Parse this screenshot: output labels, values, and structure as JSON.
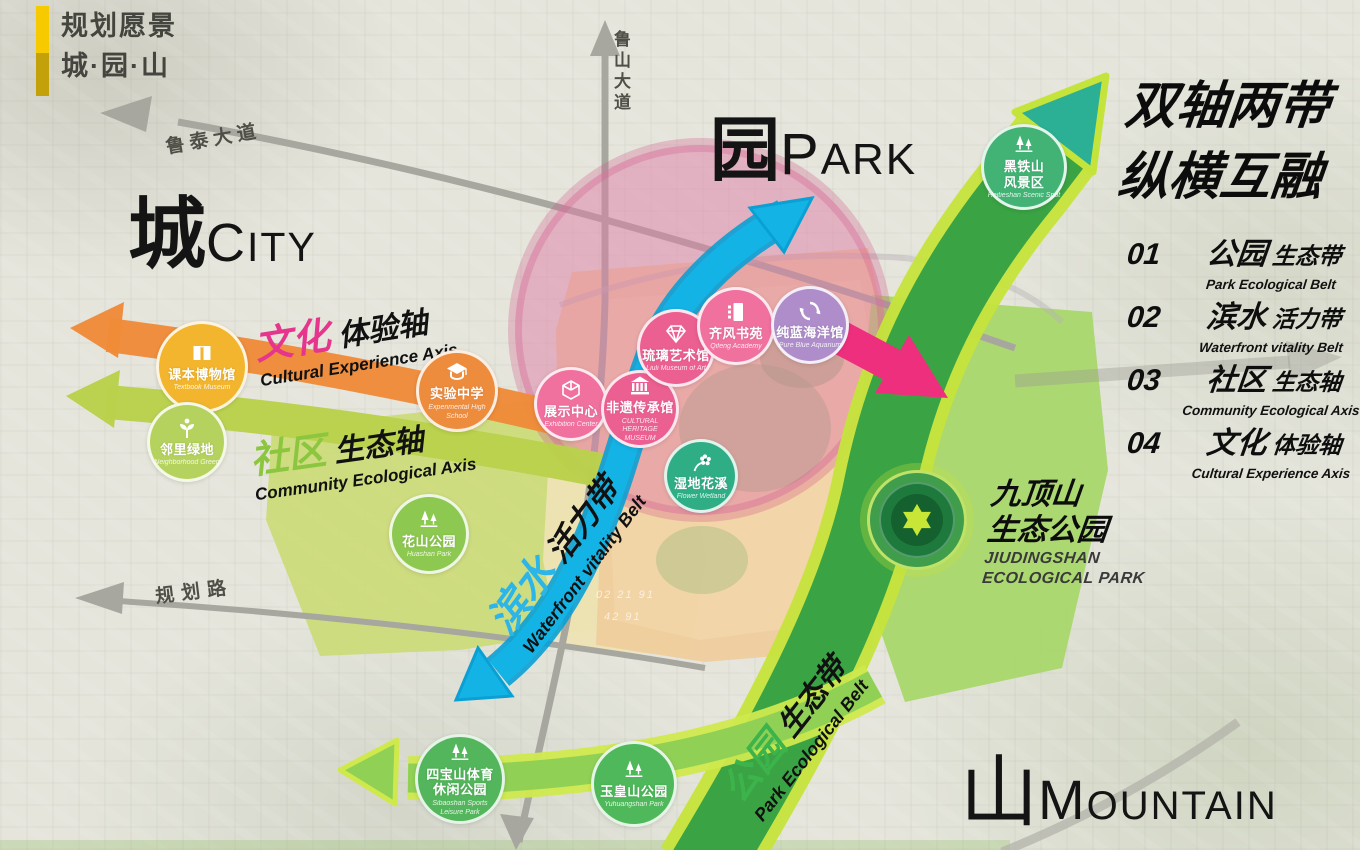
{
  "logo": {
    "line1": "规划愿景",
    "line2": "城·园·山"
  },
  "title": {
    "line1": "双轴两带",
    "line2": "纵横互融"
  },
  "zone_labels": {
    "city": {
      "cn": "城",
      "en": "CITY"
    },
    "park": {
      "cn": "园",
      "en": "PARK"
    },
    "mountain": {
      "cn": "山",
      "en": "MOUNTAIN"
    }
  },
  "legend": [
    {
      "num": "01",
      "cn": "公园",
      "cn_sub": "生态带",
      "en": "Park Ecological Belt"
    },
    {
      "num": "02",
      "cn": "滨水",
      "cn_sub": "活力带",
      "en": "Waterfront vitality Belt"
    },
    {
      "num": "03",
      "cn": "社区",
      "cn_sub": "生态轴",
      "en": "Community Ecological Axis"
    },
    {
      "num": "04",
      "cn": "文化",
      "cn_sub": "体验轴",
      "en": "Cultural Experience Axis"
    }
  ],
  "axis_labels": {
    "cultural": {
      "cn": "文化",
      "cn_sub": "体验轴",
      "en": "Cultural Experience Axis",
      "accent": "#e5358c"
    },
    "community": {
      "cn": "社区",
      "cn_sub": "生态轴",
      "en": "Community Ecological Axis",
      "accent": "#8cc63f"
    },
    "waterfront": {
      "cn": "滨水",
      "cn_sub": "活力带",
      "en": "Waterfront vitality Belt",
      "accent": "#2cb5e8"
    },
    "park_belt": {
      "cn": "公园",
      "cn_sub": "生态带",
      "en": "Park Ecological Belt",
      "accent": "#3cb44b"
    }
  },
  "roads": {
    "lutai": "鲁泰大道",
    "lushan": "鲁山大道",
    "guihua": "规划路"
  },
  "map_numbers": [
    "02 21 91",
    "42 91"
  ],
  "colors": {
    "cultural_axis": "#ef8a38",
    "community_axis": "#b9d14b",
    "waterfront_band": "#14b2e6",
    "park_belt": "#3aa344",
    "belt_edge": "#c5e43b",
    "pink_arrow": "#ee2f7e",
    "park_circle_tint": "#df7da5",
    "logo_bar": "#f7ca00"
  },
  "markers": [
    {
      "name": "textbook-museum",
      "color": "#f2b52d",
      "x": 202,
      "y": 367,
      "d": 92,
      "icon": "book",
      "cn": [
        "课本博物馆"
      ],
      "en": [
        "Textbook Museum"
      ]
    },
    {
      "name": "neighborhood-green",
      "color": "#b5d25e",
      "x": 187,
      "y": 442,
      "d": 80,
      "icon": "sprout",
      "cn": [
        "邻里绿地"
      ],
      "en": [
        "Neighborhood Green"
      ]
    },
    {
      "name": "experimental-school",
      "color": "#ee8c3e",
      "x": 457,
      "y": 391,
      "d": 82,
      "icon": "gradcap",
      "cn": [
        "实验中学"
      ],
      "en": [
        "Experimental High",
        "School"
      ]
    },
    {
      "name": "exhibition-center",
      "color": "#f0719e",
      "x": 571,
      "y": 404,
      "d": 74,
      "icon": "cube",
      "cn": [
        "展示中心"
      ],
      "en": [
        "Exhibition Center"
      ]
    },
    {
      "name": "heritage-museum",
      "color": "#ec5f91",
      "x": 640,
      "y": 409,
      "d": 78,
      "icon": "museum",
      "cn": [
        "非遗传承馆"
      ],
      "en": [
        "CULTURAL HERITAGE",
        "MUSEUM"
      ]
    },
    {
      "name": "glass-art-museum",
      "color": "#ec5f91",
      "x": 676,
      "y": 348,
      "d": 78,
      "icon": "diamond",
      "cn": [
        "琉璃艺术馆"
      ],
      "en": [
        "Liuli Museum of Art"
      ]
    },
    {
      "name": "qifeng-academy",
      "color": "#f0719e",
      "x": 736,
      "y": 326,
      "d": 78,
      "icon": "academy",
      "cn": [
        "齐风书苑"
      ],
      "en": [
        "Qifeng Academy"
      ]
    },
    {
      "name": "pure-blue-aquarium",
      "color": "#ae8dca",
      "x": 810,
      "y": 325,
      "d": 78,
      "icon": "fish",
      "cn": [
        "纯蓝海洋馆"
      ],
      "en": [
        "Pure Blue Aquarium"
      ]
    },
    {
      "name": "wetland-flower-stream",
      "color": "#2fae85",
      "x": 701,
      "y": 476,
      "d": 74,
      "icon": "flower",
      "cn": [
        "湿地花溪"
      ],
      "en": [
        "Flower Wetland"
      ]
    },
    {
      "name": "huashan-park",
      "color": "#8dc851",
      "x": 429,
      "y": 534,
      "d": 80,
      "icon": "trees",
      "cn": [
        "花山公园"
      ],
      "en": [
        "Huashan Park"
      ]
    },
    {
      "name": "heitieshan-scenic-area",
      "color": "#43b375",
      "x": 1024,
      "y": 167,
      "d": 86,
      "icon": "trees",
      "cn": [
        "黑铁山",
        "风景区"
      ],
      "en": [
        "Heitieshan Scenic Spot"
      ]
    },
    {
      "name": "sibaoshan-sports-park",
      "color": "#53b65c",
      "x": 460,
      "y": 779,
      "d": 90,
      "icon": "trees",
      "cn": [
        "四宝山体育",
        "休闲公园"
      ],
      "en": [
        "Sibaoshan Sports",
        "Leisure Park"
      ]
    },
    {
      "name": "yuhuangshan-park",
      "color": "#4eb85a",
      "x": 634,
      "y": 784,
      "d": 86,
      "icon": "trees",
      "cn": [
        "玉皇山公园"
      ],
      "en": [
        "Yuhuangshan Park"
      ]
    }
  ],
  "jiudingshan": {
    "cn1": "九顶山",
    "cn2": "生态公园",
    "en1": "JIUDINGSHAN",
    "en2": "ECOLOGICAL PARK"
  }
}
